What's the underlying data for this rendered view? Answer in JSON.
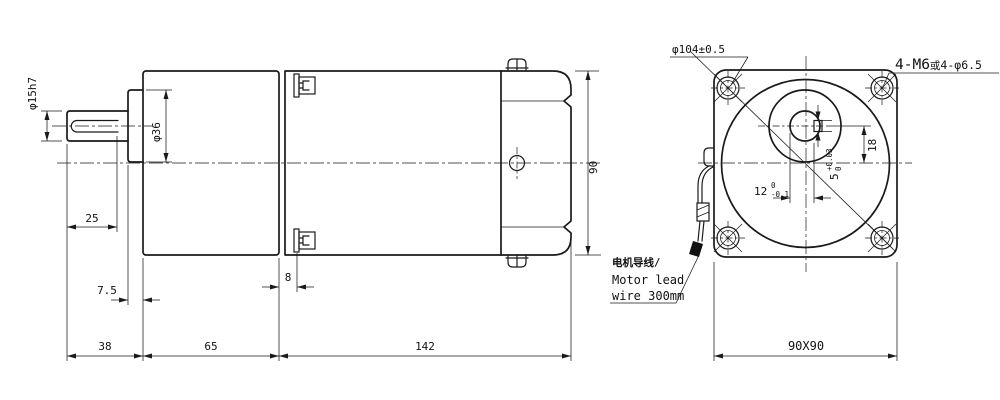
{
  "side_view": {
    "dims": {
      "shaft_diameter": "φ15h7",
      "boss_diameter": "φ36",
      "keyway_length": "25",
      "boss_protrusion": "7.5",
      "shaft_extension": "38",
      "gearbox_length": "65",
      "motor_length": "142",
      "flange_depth": "8",
      "body_height": "90"
    }
  },
  "front_view": {
    "dims": {
      "bolt_circle": "φ104±0.5",
      "mount_holes_1": "4-M6",
      "mount_holes_2": "或",
      "mount_holes_3": "4-φ6.5",
      "shaft_offset": "18",
      "square_size": "90X90",
      "keyway_width_main": "5",
      "keyway_width_upper": "+0.03",
      "keyway_width_lower": "0",
      "keyway_depth_main": "12",
      "keyway_depth_upper": "0",
      "keyway_depth_lower": "-0.1"
    },
    "wire_note": {
      "line1_cn": "电机导线/",
      "line2": "Motor lead",
      "line3": "wire 300mm"
    }
  },
  "colors": {
    "line": "#1a1a1a",
    "background": "#ffffff"
  }
}
